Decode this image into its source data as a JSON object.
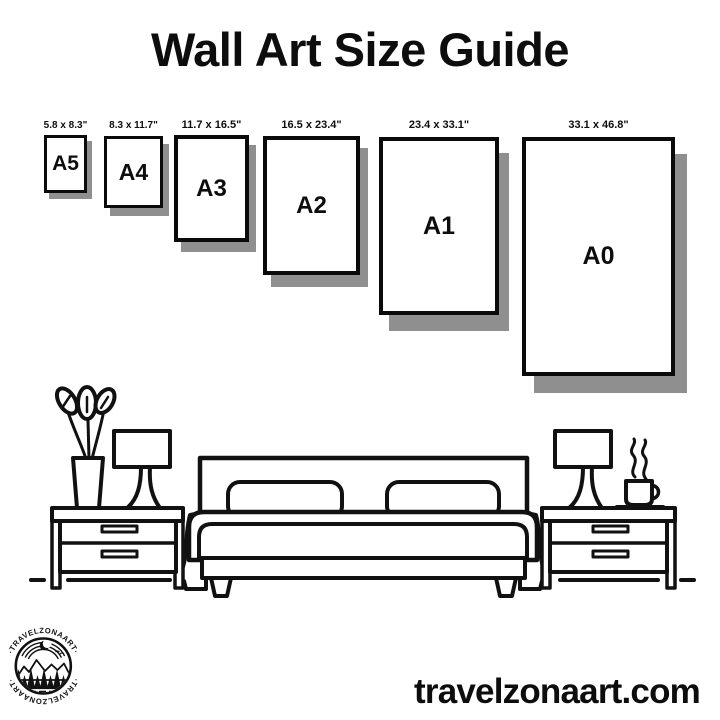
{
  "title": "Wall Art Size Guide",
  "website_url": "travelzonaart.com",
  "logo": {
    "ring_text_top": "·TRAVELZONAART·",
    "ring_text_bottom": "·TRAVELZONAART·",
    "emblem_motifs": [
      "crescent-moon-icon",
      "mountains-icon",
      "pine-trees-icon",
      "water-lines-icon",
      "birds-icon"
    ]
  },
  "colors": {
    "ink": "#111111",
    "paper_border": "#0a0a0a",
    "shadow": "#8f8f8f",
    "background": "#ffffff"
  },
  "sizes": [
    {
      "code": "A5",
      "dimensions_label": "5.8 x 8.3\"",
      "x": 44,
      "y": 135,
      "w": 43,
      "h": 58,
      "border": 3,
      "shadow_dx": 5,
      "shadow_dy": 6,
      "label_font": 10,
      "letter_font": 21
    },
    {
      "code": "A4",
      "dimensions_label": "8.3 x 11.7\"",
      "x": 104,
      "y": 136,
      "w": 59,
      "h": 72,
      "border": 3,
      "shadow_dx": 6,
      "shadow_dy": 8,
      "label_font": 10,
      "letter_font": 23
    },
    {
      "code": "A3",
      "dimensions_label": "11.7 x 16.5\"",
      "x": 174,
      "y": 135,
      "w": 75,
      "h": 107,
      "border": 4,
      "shadow_dx": 7,
      "shadow_dy": 10,
      "label_font": 11,
      "letter_font": 24
    },
    {
      "code": "A2",
      "dimensions_label": "16.5 x 23.4\"",
      "x": 263,
      "y": 136,
      "w": 97,
      "h": 139,
      "border": 4,
      "shadow_dx": 8,
      "shadow_dy": 12,
      "label_font": 11,
      "letter_font": 24
    },
    {
      "code": "A1",
      "dimensions_label": "23.4 x 33.1\"",
      "x": 379,
      "y": 137,
      "w": 120,
      "h": 178,
      "border": 4,
      "shadow_dx": 10,
      "shadow_dy": 16,
      "label_font": 11,
      "letter_font": 25
    },
    {
      "code": "A0",
      "dimensions_label": "33.1 x 46.8\"",
      "x": 522,
      "y": 137,
      "w": 153,
      "h": 239,
      "border": 4,
      "shadow_dx": 12,
      "shadow_dy": 17,
      "label_font": 11,
      "letter_font": 25
    }
  ],
  "scene_objects": [
    "plant-vase",
    "nightstand-left",
    "table-lamp-left",
    "double-bed-with-pillows",
    "table-lamp-right",
    "coffee-cup-with-steam",
    "nightstand-right",
    "floor-line"
  ]
}
